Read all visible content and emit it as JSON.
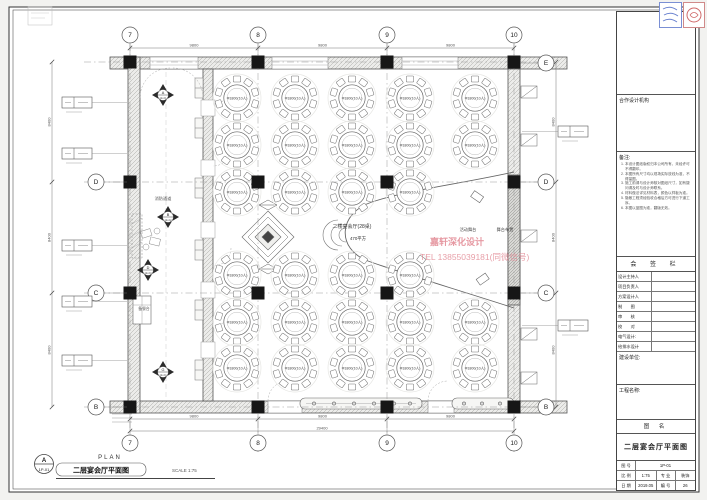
{
  "sheet": {
    "ref_letter": "A",
    "ref_code": "1P-01",
    "plan_word": "PLAN",
    "drawing_title": "二层宴会厅平面图",
    "scale_note": "SCALE 1:75"
  },
  "plan": {
    "hall_label": "二楼宴会厅(28桌)",
    "hall_area": "470平方",
    "stage_label": "活动舞台",
    "stage_label2": "舞台布置",
    "fire_lane_label": "消防通道",
    "service_counter_label": "备餐台",
    "watermark_line1": "嘉轩深化设计",
    "watermark_line2": "TEL 13855039181(同微信号)",
    "watermark_color": "#e0808c",
    "tables": {
      "label": "Φ1800(10人)",
      "seats": 10,
      "row_y": [
        98,
        145,
        192,
        275,
        322,
        368
      ],
      "col_x": [
        237,
        295,
        352,
        410,
        475
      ],
      "present": [
        [
          1,
          1,
          1,
          1,
          1
        ],
        [
          1,
          1,
          1,
          1,
          1
        ],
        [
          1,
          1,
          1,
          1,
          0
        ],
        [
          1,
          1,
          1,
          1,
          0
        ],
        [
          1,
          1,
          1,
          1,
          1
        ],
        [
          1,
          1,
          1,
          1,
          1
        ]
      ]
    },
    "grid": {
      "col_labels": [
        "7",
        "8",
        "9",
        "10"
      ],
      "col_x": [
        130,
        258,
        387,
        514
      ],
      "row_labels": [
        "E",
        "D",
        "C",
        "B"
      ],
      "row_y": [
        62,
        182,
        293,
        407
      ],
      "left_rows": [
        "D",
        "C",
        "B"
      ]
    },
    "dims": {
      "bay": "9800",
      "total": "29400",
      "side": "8400"
    },
    "view_markers": [
      {
        "letter": "A",
        "code": "1E-01",
        "x": 163,
        "y": 95
      },
      {
        "letter": "B",
        "code": "1E-02",
        "x": 168,
        "y": 217
      },
      {
        "letter": "D",
        "code": "1E-03",
        "x": 148,
        "y": 270
      },
      {
        "letter": "G",
        "code": "1E-04",
        "x": 163,
        "y": 372
      }
    ]
  },
  "titleblock": {
    "partner_label": "合作设计机构",
    "notes_title": "备注:",
    "notes": [
      "本设计图纸版权归本公司所有，未经许可不得翻印。",
      "本图所有尺寸均以现场实际放线为准，不得量图。",
      "施工前请与设计师核对图纸尺寸，如有疑问请及时与设计师联系。",
      "材料做法详见材料表，颜色以样板为准。",
      "隐蔽工程须经验收合格后方可进行下道工序。",
      "本图以蓝图为准，翻版无效。"
    ],
    "sign_title": "会 签 栏",
    "sign_rows": [
      "设计主持人",
      "项目负责人",
      "方案设计人",
      "制　　图",
      "审　　核",
      "校　　对",
      "电气设计:",
      "给排水设计"
    ],
    "owner_label": "建设单位:",
    "project_label": "工程名称:",
    "fig_label": "图  名",
    "fig_name": "二层宴会厅平面图",
    "no_label": "图 号",
    "no_value": "1P-01",
    "scale_label": "比 例",
    "scale_value": "1:75",
    "major_label": "专 业",
    "major_value": "装饰",
    "date_label": "日 期",
    "date_value": "2019.05",
    "serial_label": "编 号",
    "serial_value": "26"
  }
}
